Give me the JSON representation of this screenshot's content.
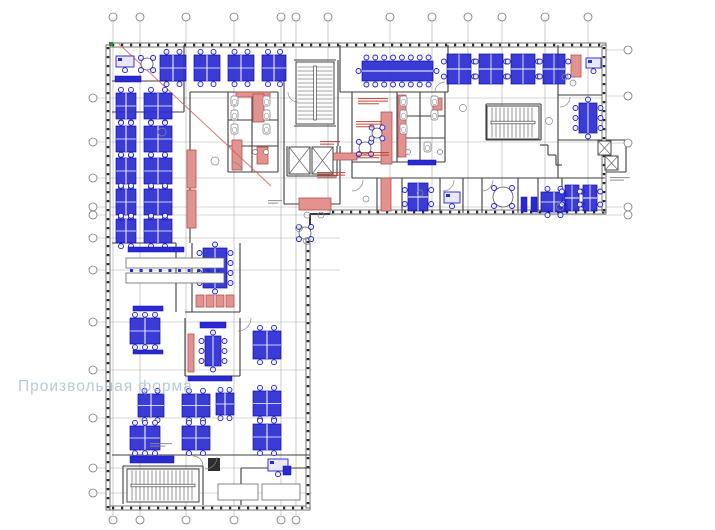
{
  "watermark": {
    "text": "Произвольная форма"
  },
  "palette": {
    "blue": "#2020cc",
    "blueFill": "#2a2ad2",
    "blueDark": "#0e0ea8",
    "redStroke": "#b4524e",
    "redFill": "#e2938f",
    "redLine": "#d4605c",
    "wall": "#2b2b2b",
    "innerWall": "#3d3d3d",
    "grid": "#9a9a9a",
    "gray": "#6b6b6b",
    "green": "#2e8b2e",
    "annotRed": "#c0392b",
    "annotGray": "#8a8a8a"
  },
  "plan": {
    "grid": {
      "bubble_r": 4,
      "v_full_xs": [
        113,
        140,
        186,
        234,
        281,
        296
      ],
      "v_short_xs": [
        328,
        390,
        432,
        468,
        502,
        545,
        588
      ],
      "v_top_y": 17,
      "v_bottom_y": 520,
      "v_line_y1": 21,
      "v_line_y2_full": 515,
      "v_line_y2_short": 213,
      "h_lines": [
        {
          "y": 98,
          "x2": 604,
          "right_bubble": false
        },
        {
          "y": 142,
          "x2": 604,
          "right_bubble": false
        },
        {
          "y": 178,
          "x2": 604,
          "right_bubble": false
        },
        {
          "y": 207,
          "x2": 622,
          "right_bubble": true
        },
        {
          "y": 215,
          "x2": 622,
          "right_bubble": true
        },
        {
          "y": 238,
          "x2": 340,
          "right_bubble": false
        },
        {
          "y": 270,
          "x2": 340,
          "right_bubble": false
        },
        {
          "y": 322,
          "x2": 312,
          "right_bubble": false
        },
        {
          "y": 370,
          "x2": 312,
          "right_bubble": false
        },
        {
          "y": 418,
          "x2": 312,
          "right_bubble": false
        },
        {
          "y": 468,
          "x2": 312,
          "right_bubble": false
        },
        {
          "y": 493,
          "x2": 312,
          "right_bubble": false
        }
      ],
      "left_bubble_x": 93,
      "h_line_x1": 97,
      "right_bubble_x": 628,
      "right_leaders_ys": [
        50,
        96,
        143
      ]
    },
    "facades": [
      {
        "x": 110,
        "y": 43,
        "len": 496,
        "dir": "h"
      },
      {
        "x": 106,
        "y": 45,
        "len": 465,
        "dir": "v"
      },
      {
        "x": 110,
        "y": 506,
        "len": 200,
        "dir": "h"
      },
      {
        "x": 306,
        "y": 230,
        "len": 278,
        "dir": "v"
      },
      {
        "x": 330,
        "y": 210,
        "len": 276,
        "dir": "h"
      },
      {
        "x": 602,
        "y": 45,
        "len": 167,
        "dir": "v"
      }
    ],
    "walls": [
      [
        112,
        81,
        184,
        81
      ],
      [
        112,
        112,
        184,
        112
      ],
      [
        184,
        45,
        184,
        112
      ],
      [
        190,
        92,
        278,
        92
      ],
      [
        190,
        92,
        190,
        243
      ],
      [
        228,
        92,
        228,
        172
      ],
      [
        278,
        92,
        278,
        172
      ],
      [
        228,
        172,
        278,
        172
      ],
      [
        252,
        92,
        252,
        172
      ],
      [
        228,
        120,
        278,
        120
      ],
      [
        228,
        146,
        278,
        146
      ],
      [
        284,
        60,
        284,
        204
      ],
      [
        338,
        60,
        338,
        146
      ],
      [
        294,
        60,
        336,
        60
      ],
      [
        294,
        126,
        336,
        126
      ],
      [
        287,
        146,
        287,
        176
      ],
      [
        337,
        146,
        337,
        176
      ],
      [
        287,
        176,
        337,
        176
      ],
      [
        284,
        204,
        340,
        204
      ],
      [
        340,
        146,
        340,
        204
      ],
      [
        340,
        45,
        340,
        92
      ],
      [
        448,
        45,
        448,
        92
      ],
      [
        340,
        92,
        448,
        92
      ],
      [
        352,
        92,
        352,
        178
      ],
      [
        397,
        92,
        397,
        162
      ],
      [
        445,
        92,
        445,
        162
      ],
      [
        352,
        162,
        445,
        162
      ],
      [
        397,
        116,
        445,
        116
      ],
      [
        397,
        138,
        445,
        138
      ],
      [
        420,
        92,
        420,
        162
      ],
      [
        352,
        178,
        605,
        178
      ],
      [
        377,
        178,
        377,
        213
      ],
      [
        402,
        178,
        402,
        213
      ],
      [
        440,
        178,
        440,
        213
      ],
      [
        463,
        178,
        463,
        213
      ],
      [
        482,
        178,
        482,
        213
      ],
      [
        518,
        178,
        518,
        213
      ],
      [
        538,
        178,
        538,
        213
      ],
      [
        562,
        178,
        562,
        213
      ],
      [
        558,
        45,
        558,
        178
      ],
      [
        558,
        95,
        602,
        95
      ],
      [
        558,
        140,
        602,
        140
      ],
      [
        540,
        145,
        548,
        145
      ],
      [
        548,
        145,
        548,
        155
      ],
      [
        548,
        155,
        556,
        155
      ],
      [
        556,
        155,
        556,
        165
      ],
      [
        556,
        165,
        562,
        165
      ],
      [
        486,
        104,
        541,
        104
      ],
      [
        486,
        140,
        541,
        140
      ],
      [
        486,
        104,
        486,
        140
      ],
      [
        541,
        104,
        541,
        140
      ],
      [
        606,
        140,
        626,
        140
      ],
      [
        626,
        140,
        626,
        172
      ],
      [
        606,
        172,
        626,
        172
      ],
      [
        310,
        214,
        330,
        214,
        2
      ],
      [
        310,
        214,
        310,
        231,
        2
      ],
      [
        112,
        243,
        176,
        243
      ],
      [
        176,
        243,
        176,
        312
      ],
      [
        192,
        243,
        192,
        312
      ],
      [
        240,
        243,
        240,
        312
      ],
      [
        185,
        312,
        240,
        312
      ],
      [
        185,
        318,
        185,
        376
      ],
      [
        240,
        318,
        240,
        376
      ],
      [
        185,
        376,
        240,
        376
      ],
      [
        112,
        455,
        310,
        455
      ],
      [
        123,
        466,
        203,
        466
      ],
      [
        123,
        466,
        123,
        504
      ],
      [
        203,
        466,
        203,
        505
      ],
      [
        241,
        468,
        310,
        468
      ],
      [
        241,
        468,
        241,
        505
      ]
    ],
    "red_rects": [
      [
        187,
        150,
        9,
        38
      ],
      [
        187,
        190,
        9,
        38
      ],
      [
        236,
        92,
        34,
        5
      ],
      [
        232,
        140,
        10,
        30
      ],
      [
        253,
        94,
        11,
        28
      ],
      [
        257,
        147,
        11,
        17
      ],
      [
        381,
        112,
        11,
        52
      ],
      [
        381,
        178,
        10,
        33
      ],
      [
        398,
        95,
        8,
        62
      ],
      [
        433,
        98,
        9,
        12
      ],
      [
        333,
        153,
        24,
        7
      ],
      [
        571,
        55,
        10,
        22
      ],
      [
        299,
        198,
        32,
        12
      ],
      [
        188,
        334,
        6,
        38
      ],
      [
        196,
        295,
        8,
        12
      ],
      [
        206,
        295,
        8,
        12
      ],
      [
        216,
        295,
        8,
        12
      ],
      [
        226,
        295,
        8,
        12
      ]
    ],
    "red_line": [
      119,
      44,
      271,
      186
    ],
    "green_mark": [
      109,
      42,
      4,
      4
    ],
    "stairs": [
      {
        "x": 296,
        "y": 62,
        "w": 38,
        "h": 62,
        "dir": "v"
      },
      {
        "x": 487,
        "y": 106,
        "w": 52,
        "h": 33,
        "dir": "h"
      },
      {
        "x": 127,
        "y": 469,
        "w": 72,
        "h": 33,
        "dir": "h"
      }
    ],
    "elevators": [
      [
        289,
        147,
        21,
        27
      ],
      [
        312,
        147,
        21,
        27
      ],
      [
        598,
        141,
        13,
        14
      ],
      [
        605,
        156,
        13,
        14
      ]
    ],
    "workstations": [
      [
        160,
        55,
        26,
        26,
        "h"
      ],
      [
        194,
        55,
        26,
        26,
        "h"
      ],
      [
        228,
        55,
        26,
        26,
        "h"
      ],
      [
        262,
        55,
        24,
        26,
        "h"
      ],
      [
        447,
        54,
        24,
        30,
        "v"
      ],
      [
        479,
        54,
        24,
        30,
        "v"
      ],
      [
        511,
        54,
        24,
        30,
        "v"
      ],
      [
        543,
        54,
        22,
        30,
        "v"
      ],
      [
        116,
        93,
        20,
        26,
        "h"
      ],
      [
        144,
        93,
        28,
        26,
        "h"
      ],
      [
        116,
        126,
        20,
        26,
        "h"
      ],
      [
        144,
        126,
        28,
        26,
        "h"
      ],
      [
        116,
        158,
        20,
        26,
        "h"
      ],
      [
        144,
        158,
        28,
        26,
        "h"
      ],
      [
        116,
        189,
        20,
        26,
        "h"
      ],
      [
        144,
        189,
        28,
        26,
        "h"
      ],
      [
        116,
        219,
        20,
        24,
        "h"
      ],
      [
        144,
        219,
        28,
        24,
        "h"
      ],
      [
        408,
        183,
        20,
        28,
        "v"
      ],
      [
        541,
        192,
        26,
        20,
        "h"
      ],
      [
        565,
        185,
        14,
        26,
        "v"
      ],
      [
        583,
        185,
        14,
        26,
        "v"
      ],
      [
        130,
        318,
        30,
        26,
        "h"
      ],
      [
        253,
        331,
        28,
        28,
        "h"
      ],
      [
        138,
        394,
        26,
        23,
        "h"
      ],
      [
        182,
        394,
        28,
        23,
        "h"
      ],
      [
        216,
        393,
        18,
        22,
        "h"
      ],
      [
        253,
        391,
        28,
        25,
        "h"
      ],
      [
        130,
        426,
        30,
        24,
        "h"
      ],
      [
        182,
        426,
        28,
        24,
        "h"
      ],
      [
        253,
        424,
        28,
        26,
        "h"
      ]
    ],
    "conference_tables": [
      {
        "x": 362,
        "y": 61,
        "w": 71,
        "h": 20,
        "t": 8,
        "b": 8,
        "l": 1,
        "r": 1
      },
      {
        "x": 203,
        "y": 248,
        "w": 24,
        "h": 40,
        "t": 1,
        "b": 1,
        "l": 4,
        "r": 4
      },
      {
        "x": 205,
        "y": 336,
        "w": 16,
        "h": 30,
        "t": 1,
        "b": 1,
        "l": 3,
        "r": 3
      },
      {
        "x": 579,
        "y": 103,
        "w": 18,
        "h": 30,
        "t": 1,
        "b": 1,
        "l": 3,
        "r": 3
      }
    ],
    "round_tables": [
      [
        503,
        197,
        10
      ],
      [
        147,
        64,
        6
      ],
      [
        365,
        148,
        6
      ],
      [
        377,
        133,
        5
      ],
      [
        305,
        233,
        6
      ]
    ],
    "single_desks": [
      [
        116,
        56,
        18,
        11
      ],
      [
        444,
        192,
        16,
        11
      ],
      [
        586,
        58,
        15,
        10
      ],
      [
        268,
        459,
        20,
        12
      ]
    ],
    "blue_rects": [
      [
        115,
        76,
        26,
        6
      ],
      [
        408,
        160,
        28,
        5
      ],
      [
        521,
        197,
        6,
        15
      ],
      [
        531,
        197,
        6,
        15
      ],
      [
        128,
        247,
        56,
        5
      ],
      [
        133,
        306,
        30,
        5
      ],
      [
        133,
        350,
        30,
        4
      ],
      [
        200,
        322,
        26,
        6
      ],
      [
        130,
        456,
        44,
        7
      ],
      [
        283,
        466,
        8,
        9
      ],
      [
        188,
        376,
        44,
        5
      ]
    ],
    "gray_rects": [
      [
        126,
        258,
        98,
        10
      ],
      [
        126,
        273,
        98,
        10
      ],
      [
        218,
        484,
        40,
        16
      ],
      [
        262,
        484,
        38,
        16
      ]
    ],
    "dark_rects": [
      [
        208,
        458,
        12,
        13
      ]
    ],
    "stool_rows": [
      {
        "x": 130,
        "y": 269,
        "n": 10,
        "dx": 9.6
      }
    ],
    "wc_fixtures": [
      [
        231,
        96
      ],
      [
        231,
        110
      ],
      [
        231,
        124
      ],
      [
        263,
        96
      ],
      [
        263,
        110
      ],
      [
        263,
        124
      ],
      [
        400,
        96
      ],
      [
        400,
        110
      ],
      [
        400,
        124
      ],
      [
        431,
        96
      ],
      [
        431,
        110
      ],
      [
        424,
        142
      ]
    ],
    "sinks": [
      [
        255,
        152,
        2.5
      ],
      [
        266,
        152,
        2.5
      ],
      [
        440,
        152,
        2.5
      ],
      [
        408,
        152,
        2.5
      ]
    ],
    "plants": [
      [
        162,
        132,
        4
      ],
      [
        215,
        161,
        4
      ],
      [
        299,
        228,
        3.5
      ],
      [
        307,
        241,
        3.5
      ],
      [
        463,
        108,
        3.5
      ],
      [
        549,
        121,
        3.5
      ],
      [
        560,
        207,
        3.5
      ],
      [
        420,
        193,
        3
      ],
      [
        366,
        199,
        3
      ],
      [
        573,
        83,
        3
      ],
      [
        565,
        77,
        3
      ],
      [
        307,
        215,
        3
      ],
      [
        321,
        215,
        3
      ]
    ],
    "door_arcs": [
      [
        238,
        318,
        13,
        1
      ],
      [
        232,
        172,
        10,
        0
      ],
      [
        352,
        180,
        11,
        1
      ],
      [
        443,
        180,
        11,
        1
      ],
      [
        482,
        180,
        11,
        1
      ],
      [
        205,
        457,
        12,
        1
      ],
      [
        298,
        92,
        10,
        2
      ],
      [
        560,
        97,
        10,
        1
      ],
      [
        193,
        466,
        10,
        0
      ],
      [
        445,
        92,
        10,
        3
      ]
    ],
    "micro_texts": [
      [
        358,
        98,
        30,
        3,
        "annotRed"
      ],
      [
        356,
        121,
        26,
        3,
        "annotRed"
      ],
      [
        357,
        152,
        32,
        3,
        "annotRed"
      ],
      [
        317,
        172,
        28,
        3,
        "annotRed"
      ],
      [
        320,
        141,
        20,
        2,
        "annotRed"
      ],
      [
        610,
        177,
        20,
        2,
        "annotGray"
      ],
      [
        150,
        443,
        22,
        2,
        "annotGray"
      ],
      [
        268,
        200,
        14,
        2,
        "annotGray"
      ]
    ]
  }
}
